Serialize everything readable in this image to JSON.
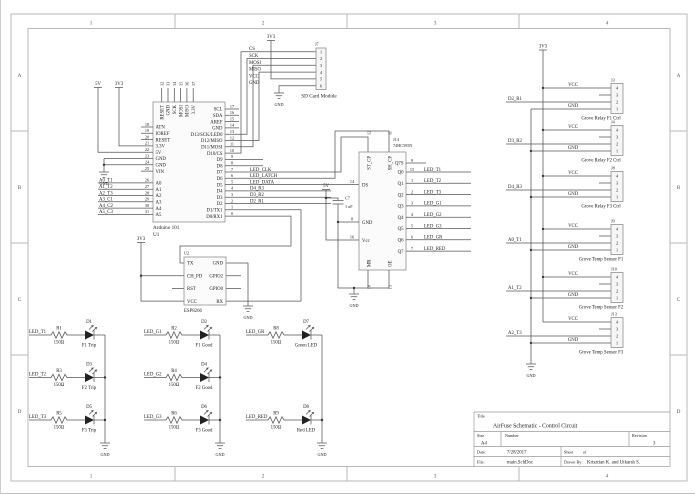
{
  "frame": {
    "cols": [
      "1",
      "2",
      "3",
      "4"
    ],
    "rows": [
      "A",
      "B",
      "C",
      "D"
    ]
  },
  "title_block": {
    "title_label": "Title",
    "title": "AirFuse Schematic - Control Circuit",
    "size_label": "Size",
    "size": "A4",
    "number_label": "Number",
    "revision_label": "Revision",
    "revision": "3",
    "date_label": "Date:",
    "date": "7/28/2017",
    "sheet_label": "Sheet",
    "sheet_of": "of",
    "file_label": "File:",
    "file": "main.SchDoc",
    "drawn_label": "Drawn By:",
    "drawn_by": "Krisztian K. and Utkarsh S."
  },
  "power": {
    "v3": "3V3",
    "v5": "5V",
    "gnd": "GND"
  },
  "arduino": {
    "ref": "U1",
    "name": "Arduino 101",
    "top_pins": [
      {
        "num": "32",
        "name": "RESET"
      },
      {
        "num": "33",
        "name": "GND"
      },
      {
        "num": "34",
        "name": "SCK"
      },
      {
        "num": "35",
        "name": "MOSI"
      },
      {
        "num": "36",
        "name": "MISO"
      },
      {
        "num": "37",
        "name": "3.3V"
      }
    ],
    "left_pins": [
      {
        "num": "18",
        "name": "ATN"
      },
      {
        "num": "19",
        "name": "IOREF"
      },
      {
        "num": "20",
        "name": "RESET"
      },
      {
        "num": "21",
        "name": "3.3V"
      },
      {
        "num": "22",
        "name": "5V"
      },
      {
        "num": "23",
        "name": "GND"
      },
      {
        "num": "24",
        "name": "GND"
      },
      {
        "num": "25",
        "name": "VIN"
      }
    ],
    "analog_pins": [
      {
        "num": "26",
        "name": "A0",
        "net": "A0_T1"
      },
      {
        "num": "27",
        "name": "A1",
        "net": "A1_T2"
      },
      {
        "num": "28",
        "name": "A2",
        "net": "A2_T3"
      },
      {
        "num": "29",
        "name": "A3",
        "net": "A3_C1"
      },
      {
        "num": "30",
        "name": "A4",
        "net": "A4_C2"
      },
      {
        "num": "31",
        "name": "A5",
        "net": "A5_C3"
      }
    ],
    "right_pins": [
      {
        "num": "17",
        "name": "SCL"
      },
      {
        "num": "16",
        "name": "SDA"
      },
      {
        "num": "15",
        "name": "AREF"
      },
      {
        "num": "14",
        "name": "GND"
      },
      {
        "num": "13",
        "name": "D13/SCK/LED0"
      },
      {
        "num": "12",
        "name": "D12/MISO"
      },
      {
        "num": "11",
        "name": "D11/MOSI"
      },
      {
        "num": "10",
        "name": "D10/CS"
      },
      {
        "num": "9",
        "name": "D9"
      },
      {
        "num": "8",
        "name": "D8"
      },
      {
        "num": "7",
        "name": "D7"
      },
      {
        "num": "6",
        "name": "D6"
      },
      {
        "num": "5",
        "name": "D5"
      },
      {
        "num": "4",
        "name": "D4"
      },
      {
        "num": "3",
        "name": "D3"
      },
      {
        "num": "2",
        "name": "D2"
      },
      {
        "num": "1",
        "name": "D1/TX1"
      },
      {
        "num": "0",
        "name": "D0/RX1"
      }
    ]
  },
  "nets": {
    "clk": "LED_CLK",
    "latch": "LED_LATCH",
    "data": "LED_DATA",
    "r3": "D4_R3",
    "r2": "D3_R2",
    "r1": "D2_R1"
  },
  "sd": {
    "ref": "J7",
    "name": "SD Card Module",
    "pins": [
      {
        "num": "1",
        "name": "CS"
      },
      {
        "num": "2",
        "name": "SCK"
      },
      {
        "num": "3",
        "name": "MOSI"
      },
      {
        "num": "4",
        "name": "MISO"
      },
      {
        "num": "5",
        "name": "VCC"
      },
      {
        "num": "6",
        "name": "GND"
      }
    ]
  },
  "sr": {
    "ref": "J14",
    "part": "74HC595N",
    "top_pins": [
      {
        "num": "12",
        "name": "ST_CP"
      },
      {
        "num": "11",
        "name": "SH_CP"
      }
    ],
    "ds": {
      "num": "14",
      "name": "DS"
    },
    "gnd": {
      "num": "8",
      "name": "GND"
    },
    "vcc": {
      "num": "16",
      "name": "Vcc"
    },
    "bottom_pins": [
      {
        "num": "10",
        "name": "MR"
      },
      {
        "num": "13",
        "name": "OE"
      }
    ],
    "right_pins": [
      {
        "num": "9",
        "name": "Q7S",
        "net": ""
      },
      {
        "num": "15",
        "name": "Q0",
        "net": "LED_T1"
      },
      {
        "num": "1",
        "name": "Q1",
        "net": "LED_T2"
      },
      {
        "num": "2",
        "name": "Q2",
        "net": "LED_T3"
      },
      {
        "num": "3",
        "name": "Q3",
        "net": "LED_G1"
      },
      {
        "num": "4",
        "name": "Q4",
        "net": "LED_G2"
      },
      {
        "num": "5",
        "name": "Q5",
        "net": "LED_G3"
      },
      {
        "num": "6",
        "name": "Q6",
        "net": "LED_GR"
      },
      {
        "num": "7",
        "name": "Q7",
        "net": "LED_RED"
      }
    ],
    "cap": {
      "ref": "C7",
      "value": "1 uF"
    }
  },
  "esp": {
    "ref": "U2",
    "name": "ESP8266",
    "left_pins": [
      "TX",
      "CH_PD",
      "RST",
      "VCC"
    ],
    "right_pins": [
      "GND",
      "GPIO2",
      "GPIO0",
      "RX"
    ]
  },
  "leds": {
    "g1": [
      {
        "net": "LED_T1",
        "res": "R1",
        "val": "150Ω",
        "led": "D1",
        "label": "F1 Trip"
      },
      {
        "net": "LED_T2",
        "res": "R3",
        "val": "150Ω",
        "led": "D3",
        "label": "F2 Trip"
      },
      {
        "net": "LED_T3",
        "res": "R5",
        "val": "150Ω",
        "led": "D5",
        "label": "F3 Trip"
      }
    ],
    "g2": [
      {
        "net": "LED_G1",
        "res": "R2",
        "val": "150Ω",
        "led": "D2",
        "label": "F1 Good"
      },
      {
        "net": "LED_G2",
        "res": "R4",
        "val": "150Ω",
        "led": "D4",
        "label": "F2 Good"
      },
      {
        "net": "LED_G3",
        "res": "R6",
        "val": "150Ω",
        "led": "D6",
        "label": "F3 Good"
      }
    ],
    "g3": [
      {
        "net": "LED_GR",
        "res": "R8",
        "val": "150Ω",
        "led": "D7",
        "label": "Green LED"
      },
      {
        "net": "LED_RED",
        "res": "R9",
        "val": "150Ω",
        "led": "D8",
        "label": "Red LED"
      }
    ]
  },
  "grove": {
    "vcc": "VCC",
    "gnd": "GND",
    "pins": [
      "4",
      "3",
      "2",
      "1"
    ],
    "items": [
      {
        "ref": "J3",
        "name": "Grove Relay F1 Ctrl",
        "net": "D2_R1"
      },
      {
        "ref": "J4",
        "name": "Grove Relay F2 Ctrl",
        "net": "D3_R2"
      },
      {
        "ref": "J8",
        "name": "Grove Relay F3 Ctrl",
        "net": "D4_R3"
      },
      {
        "ref": "J9",
        "name": "Grove Temp Sensor F1",
        "net": "A0_T1"
      },
      {
        "ref": "J10",
        "name": "Grove Temp Sensor F2",
        "net": "A1_T2"
      },
      {
        "ref": "J13",
        "name": "Grove Temp Sensor F3",
        "net": "A2_T3"
      }
    ]
  }
}
